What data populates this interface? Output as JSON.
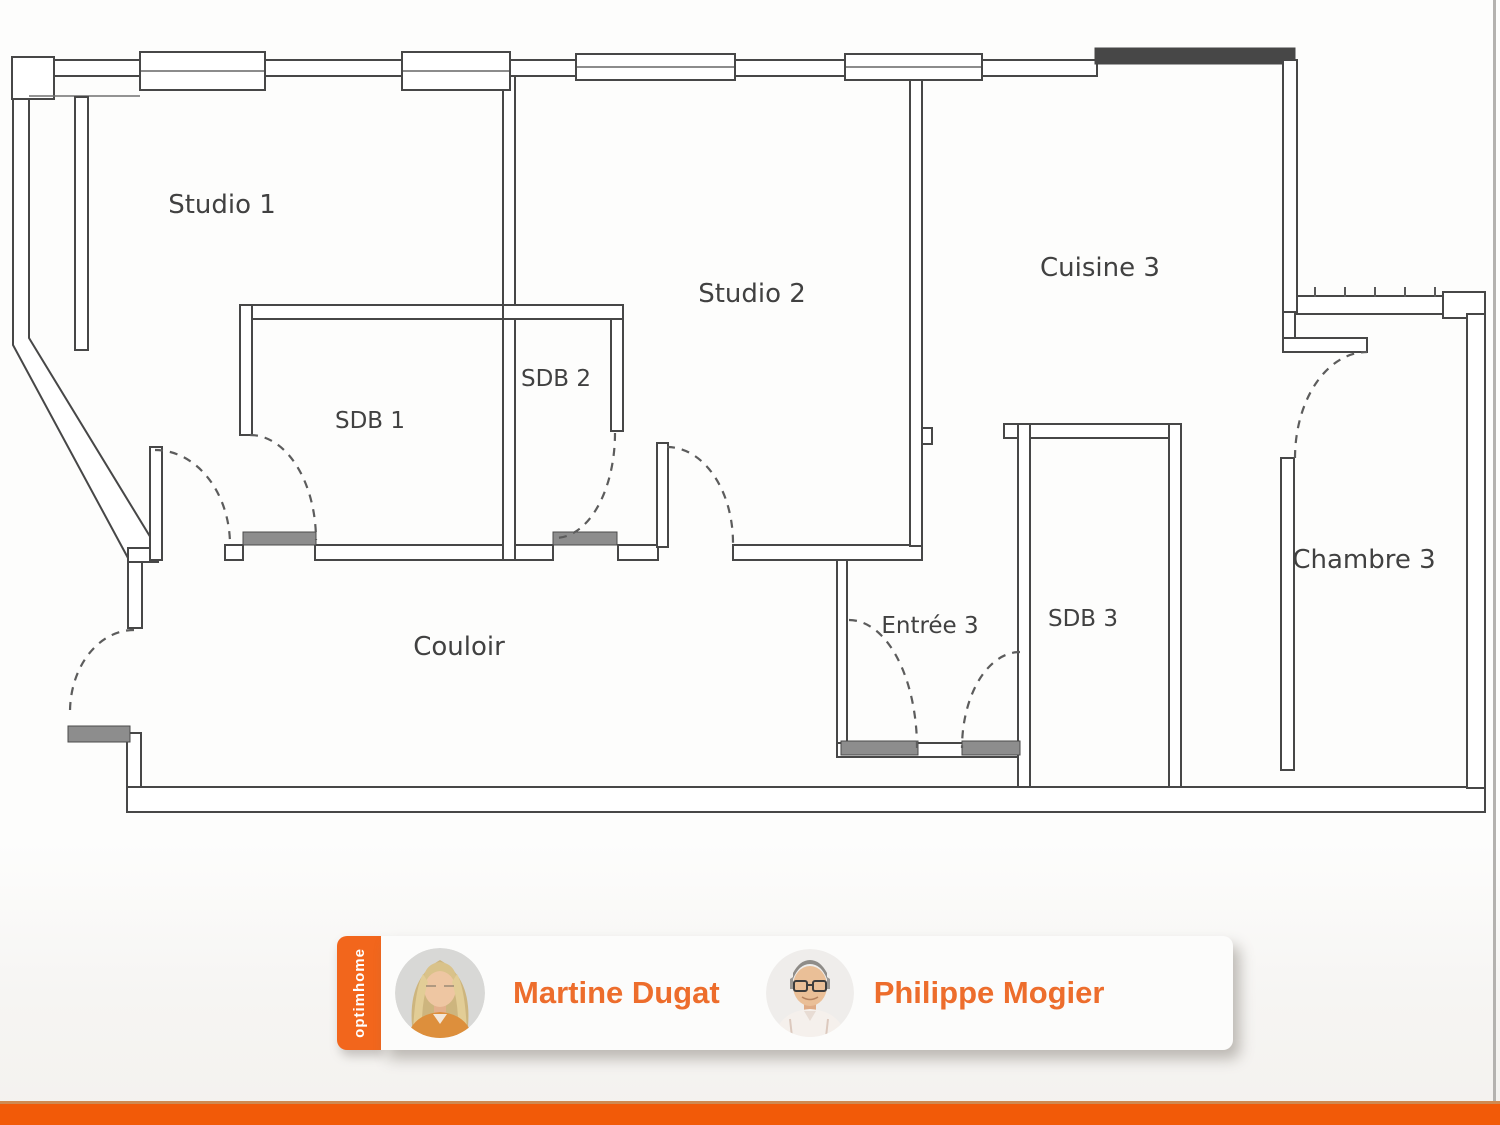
{
  "plan": {
    "rooms": {
      "studio1": "Studio 1",
      "studio2": "Studio 2",
      "cuisine3": "Cuisine 3",
      "sdb1": "SDB 1",
      "sdb2": "SDB 2",
      "sdb3": "SDB 3",
      "chambre3": "Chambre 3",
      "entree3": "Entrée 3",
      "couloir": "Couloir"
    }
  },
  "banner": {
    "brand": "optimhome",
    "agents": [
      {
        "name": "Martine Dugat"
      },
      {
        "name": "Philippe Mogier"
      }
    ]
  },
  "colors": {
    "bar": "#f25a08",
    "tab": "#f2661c",
    "name": "#ed6d2c",
    "wall": "#474747"
  }
}
